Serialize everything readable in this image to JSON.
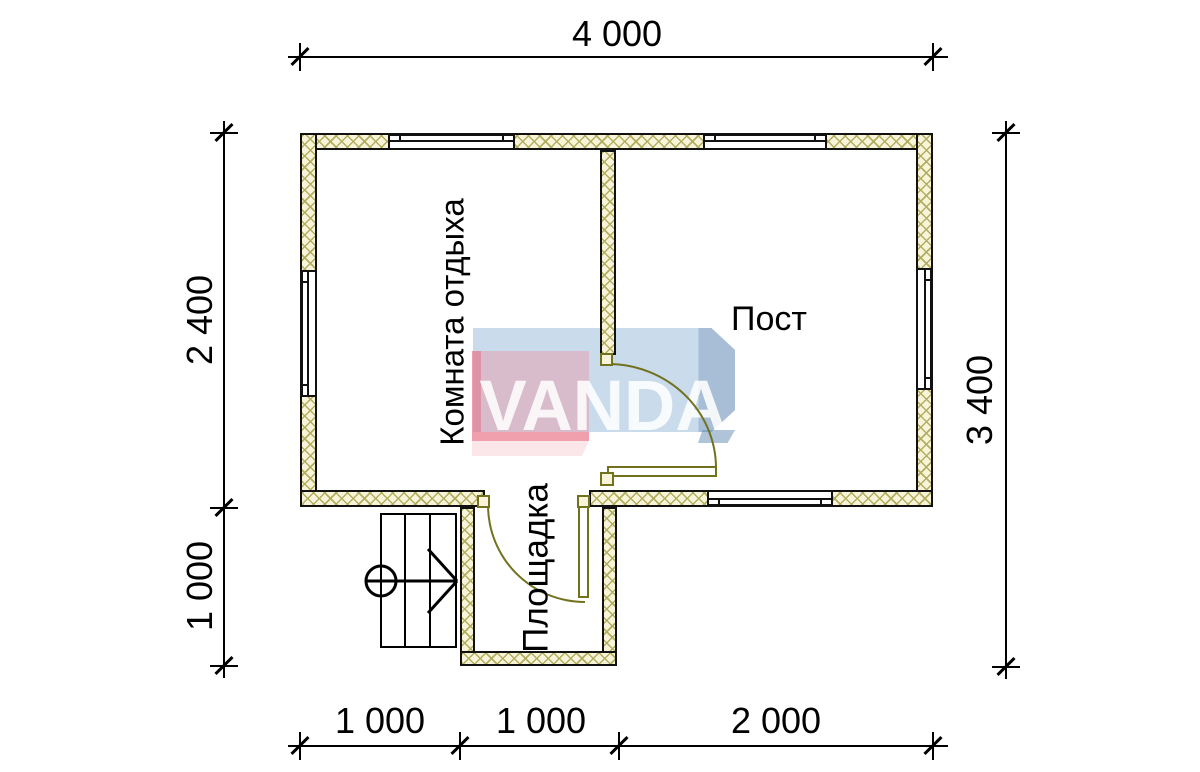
{
  "plan": {
    "rooms": [
      {
        "label": "Комната отдыха"
      },
      {
        "label": "Пост"
      },
      {
        "label": "Площадка"
      }
    ],
    "dimensions": {
      "top": "4 000",
      "left_upper": "2 400",
      "left_lower": "1 000",
      "right": "3 400",
      "bottom": [
        "1 000",
        "1 000",
        "2 000"
      ]
    }
  },
  "watermark": {
    "text": "VANDA",
    "pink_color": "#f3c3cc",
    "blue_color": "#cadeef"
  },
  "colors": {
    "wall_fill": "#f7f4da",
    "wall_hatch": "#b3ae5f",
    "door_line": "#72721e",
    "drawing_line": "#111111"
  }
}
